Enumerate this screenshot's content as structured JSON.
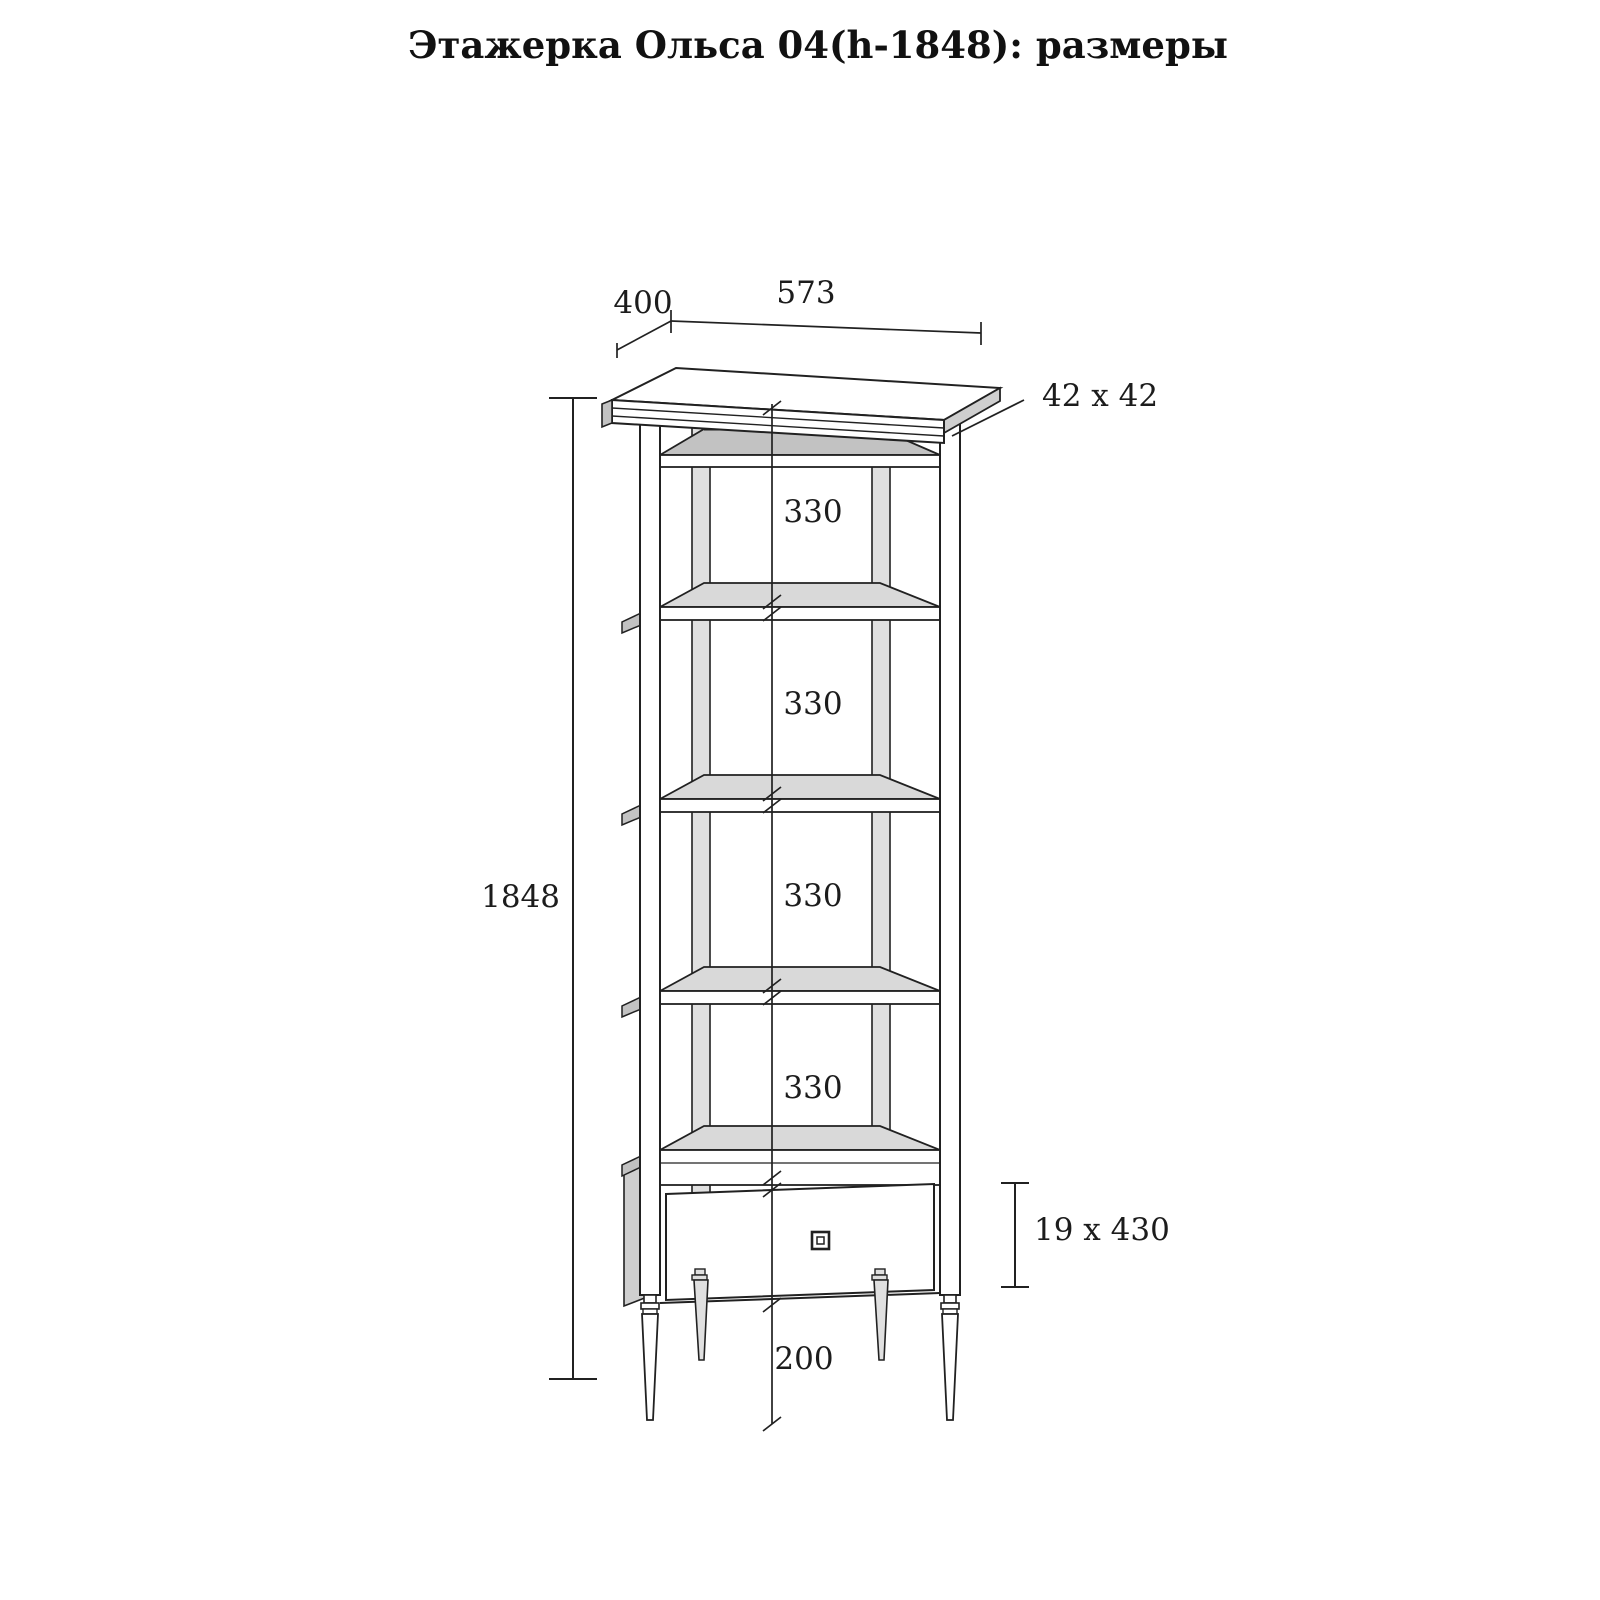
{
  "title": "Этажерка Ольса 04(h-1848): размеры",
  "dimensions": {
    "depth": "400",
    "width": "573",
    "post_section": "42 x 42",
    "shelf_gaps": [
      "330",
      "330",
      "330",
      "330"
    ],
    "total_height": "1848",
    "drawer_front": "19 x 430",
    "leg_height": "200"
  },
  "colors": {
    "background": "#ffffff",
    "line": "#212121",
    "shelf_fill": "#d9d9d9",
    "top_board_fill": "#c2c2c2",
    "side_panel_fill": "#cfcfcf",
    "text": "#1c1c1c"
  }
}
